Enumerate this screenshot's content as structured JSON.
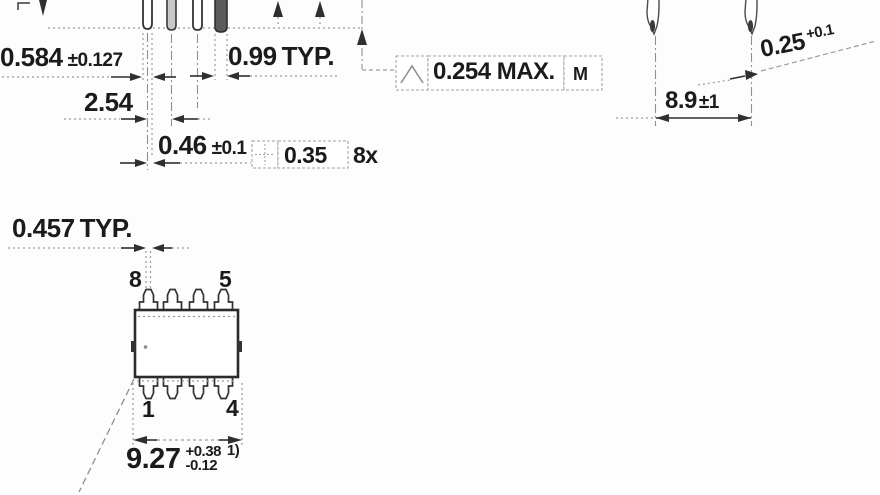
{
  "front_view": {
    "lead_offset": {
      "value": "0.584",
      "tolerance": "±0.127"
    },
    "pitch": {
      "value": "2.54"
    },
    "lead_width": {
      "value": "0.46",
      "tolerance": "±0.1"
    },
    "lead_end_width": {
      "value": "0.99",
      "qualifier": "TYP."
    },
    "coplanarity_callout": {
      "symbol": "seating-plane-icon",
      "value": "0.254 MAX.",
      "modifier": "M"
    },
    "position_callout": {
      "symbol": "position-icon",
      "value": "0.35",
      "count": "8x"
    }
  },
  "side_view": {
    "row_span": {
      "value": "8.9",
      "tolerance": "±1"
    },
    "lead_thickness": {
      "value": "0.25",
      "tolerance_plus": "+0.1"
    }
  },
  "top_view": {
    "lead_tip_width": {
      "value": "0.457",
      "qualifier": "TYP."
    },
    "body_length": {
      "value": "9.27",
      "tolerance_plus": "+0.38",
      "tolerance_minus": "-0.12",
      "footnote": "1)"
    },
    "pins": {
      "top_left": "8",
      "top_right": "5",
      "bottom_left": "1",
      "bottom_right": "4"
    }
  },
  "colors": {
    "line": "#2f2f2f",
    "dotted": "#9b9b9b",
    "callout_border": "#b3b3b3",
    "text": "#1b1b1b",
    "background": "#fdfdfd"
  }
}
